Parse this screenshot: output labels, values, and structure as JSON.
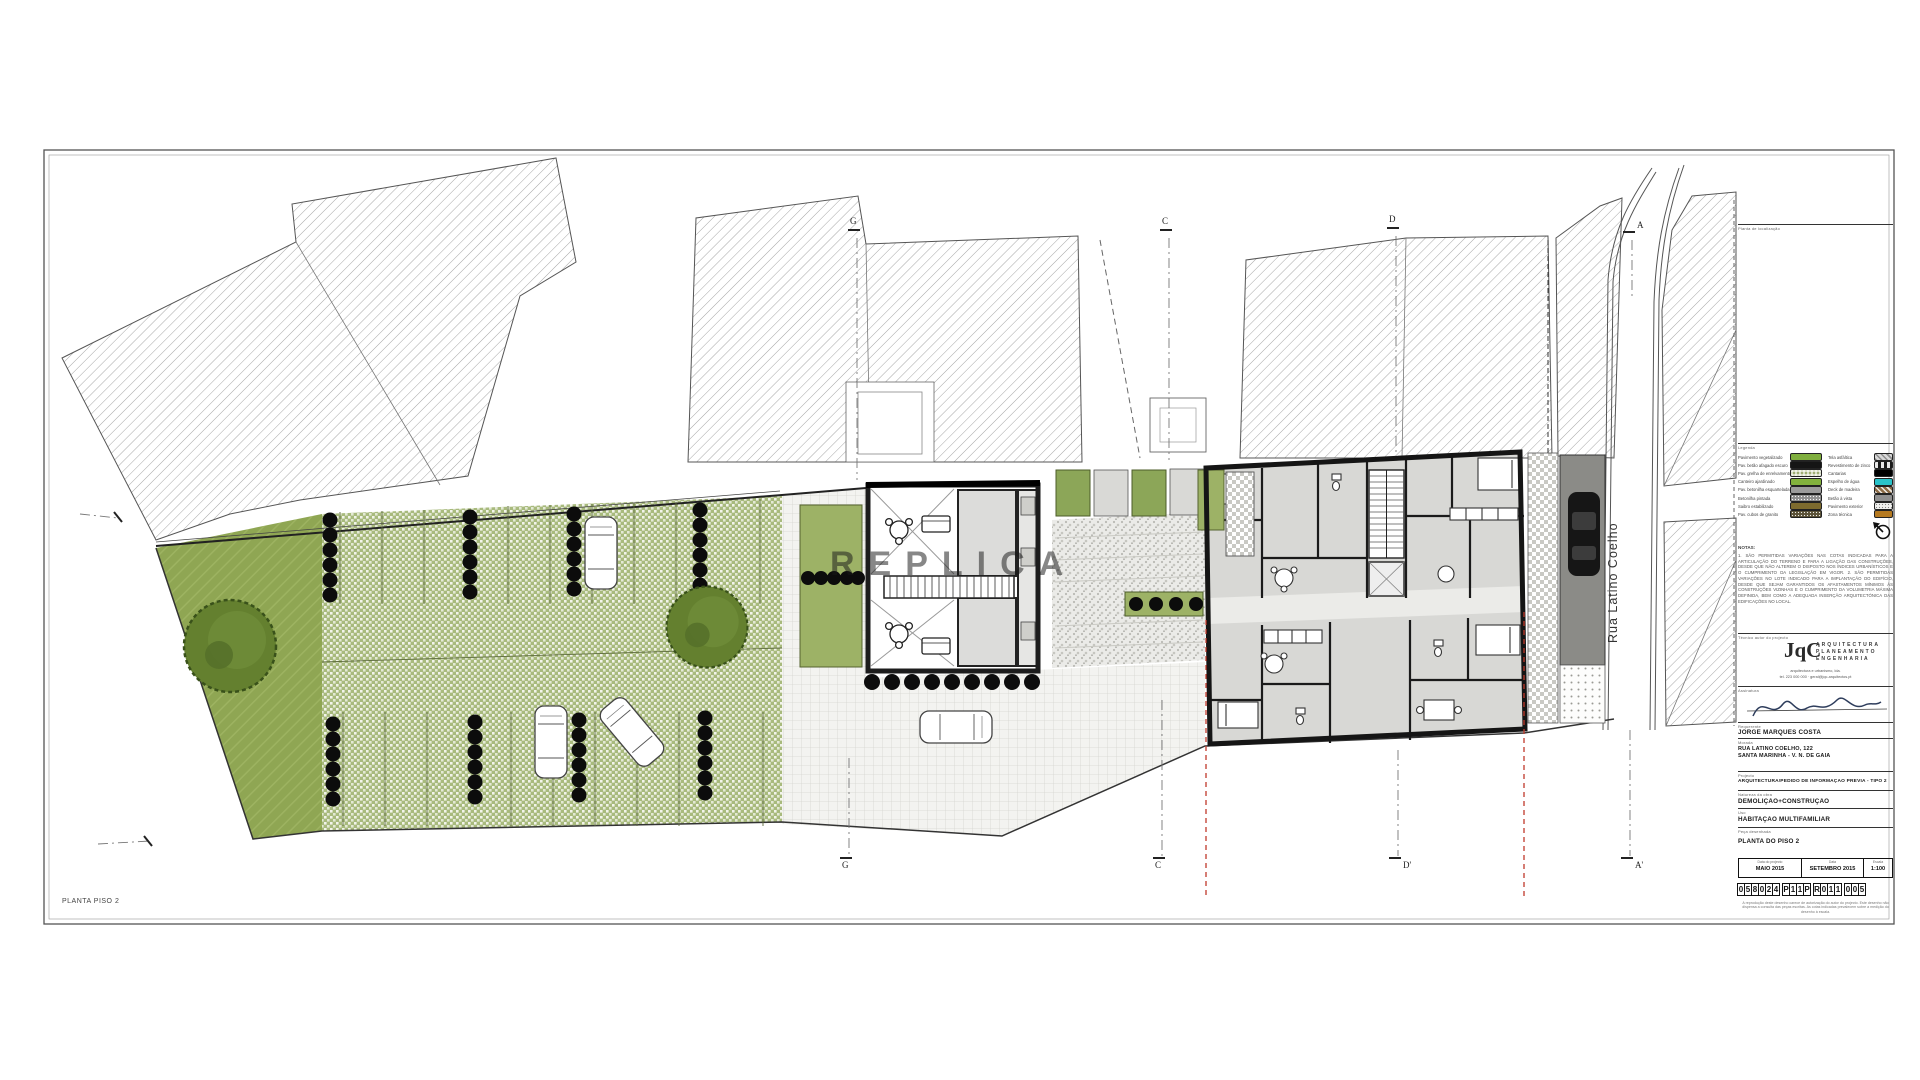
{
  "sheet": {
    "corner_label": "PLANTA PISO 2",
    "watermark": "REPLICA"
  },
  "street": {
    "name": "Rua Latino Coelho"
  },
  "grid_markers": {
    "top": [
      "G",
      "C",
      "D",
      "A"
    ],
    "bottom": [
      "G",
      "C",
      "D'",
      "A'"
    ]
  },
  "legend": {
    "title": "Legenda",
    "left": [
      {
        "label": "Pavimento vegetalizado",
        "color": "#7fae3e"
      },
      {
        "label": "Pav. betão afagado escuro",
        "color": "#151515"
      },
      {
        "label": "Pav. grelha de enrelvamento",
        "color": "#9fae74"
      },
      {
        "label": "Canteiro ajardinado",
        "color": "#82b23d"
      },
      {
        "label": "Pav. betonilha esquartelada",
        "color": "#9c9c9c"
      },
      {
        "label": "Betonilha pintada",
        "color": "#8f8f8f"
      },
      {
        "label": "Saibro estabilizado",
        "color": "#7d6b2e"
      },
      {
        "label": "Pav. cubos de granito",
        "color": "#5a5136"
      }
    ],
    "right": [
      {
        "label": "Tela asfáltica",
        "color": "#d8d8d8"
      },
      {
        "label": "Revestimento de zinco",
        "color": "#1a1a1a"
      },
      {
        "label": "Cantarias",
        "color": "#000000"
      },
      {
        "label": "Espelho de água",
        "color": "#29c2c9"
      },
      {
        "label": "Deck de madeira",
        "color": "#8a6a45"
      },
      {
        "label": "Betão à vista",
        "color": "#909090"
      },
      {
        "label": "Pavimento exterior",
        "color": "#f0f0ee"
      },
      {
        "label": "Zona técnica",
        "color": "#b5791f"
      }
    ]
  },
  "titleblock": {
    "section_labels": {
      "location": "Planta de localização",
      "technician": "Técnico autor do projecto",
      "signature": "Assinatura",
      "client": "Requerente",
      "address": "Morada",
      "project": "Projecto",
      "nature": "Natureza da obra",
      "use": "Uso",
      "piece": "Peça desenhada",
      "date1": "Data do projecto",
      "date2": "Data",
      "scale": "Escala"
    },
    "notes_title": "NOTAS:",
    "notes": "1. SÃO PERMITIDAS VARIAÇÕES NAS COTAS INDICADAS PARA A ARTICULAÇÃO DO TERRENO E PARA A LIGAÇÃO DAS CONSTRUÇÕES, DESDE QUE NÃO ALTEREM O DISPOSTO NOS ÍNDICES URBANÍSTICOS E O CUMPRIMENTO DA LEGISLAÇÃO EM VIGOR.  2. SÃO PERMITIDAS VARIAÇÕES NO LOTE INDICADO PARA A IMPLANTAÇÃO DO EDIFÍCIO, DESDE QUE SEJAM GARANTIDOS OS AFASTAMENTOS MÍNIMOS ÀS CONSTRUÇÕES VIZINHAS E O CUMPRIMENTO DA VOLUMETRIA MÁXIMA DEFINIDA, BEM COMO A ADEQUADA INSERÇÃO ARQUITECTÓNICA DAS EDIFICAÇÕES NO LOCAL.",
    "firm": {
      "monogram": "JqC",
      "line1": "ARQUITECTURA",
      "line2": "PLANEAMENTO",
      "line3": "ENGENHARIA",
      "address1": "arquitectura e urbanismo, lda.",
      "address2": "tel. 223 000 000 · geral@jqc-arquitectos.pt"
    },
    "client_name": "JORGE MARQUES COSTA",
    "address_line1": "RUA LATINO COELHO, 122",
    "address_line2": "SANTA MARINHA - V. N. DE GAIA",
    "project": "ARQUITECTURA/PEDIDO DE INFORMAÇÃO PRÉVIA - TIPO 2",
    "nature": "DEMOLIÇÃO+CONSTRUÇÃO",
    "use": "HABITAÇÃO MULTIFAMILIAR",
    "piece": "PLANTA DO PISO 2",
    "date1": "MAIO 2015",
    "date2": "SETEMBRO 2015",
    "scale": "1:100",
    "process_groups": [
      [
        "0",
        "5",
        "8",
        "0",
        "2",
        "4"
      ],
      [
        "P",
        "1",
        "1",
        "P"
      ],
      [
        "R",
        "0",
        "1",
        "1"
      ],
      [
        "0",
        "0",
        "5"
      ]
    ],
    "fine_print": "A reprodução deste desenho carece de autorização do autor do projecto. Este desenho não dispensa a consulta das peças escritas. As cotas indicadas prevalecem sobre a medição do desenho à escala."
  },
  "colors": {
    "lawn": "#8fa653",
    "grass_pavers": "#a8ba7d",
    "tree": "#64802f",
    "red_line": "#c0392b"
  }
}
